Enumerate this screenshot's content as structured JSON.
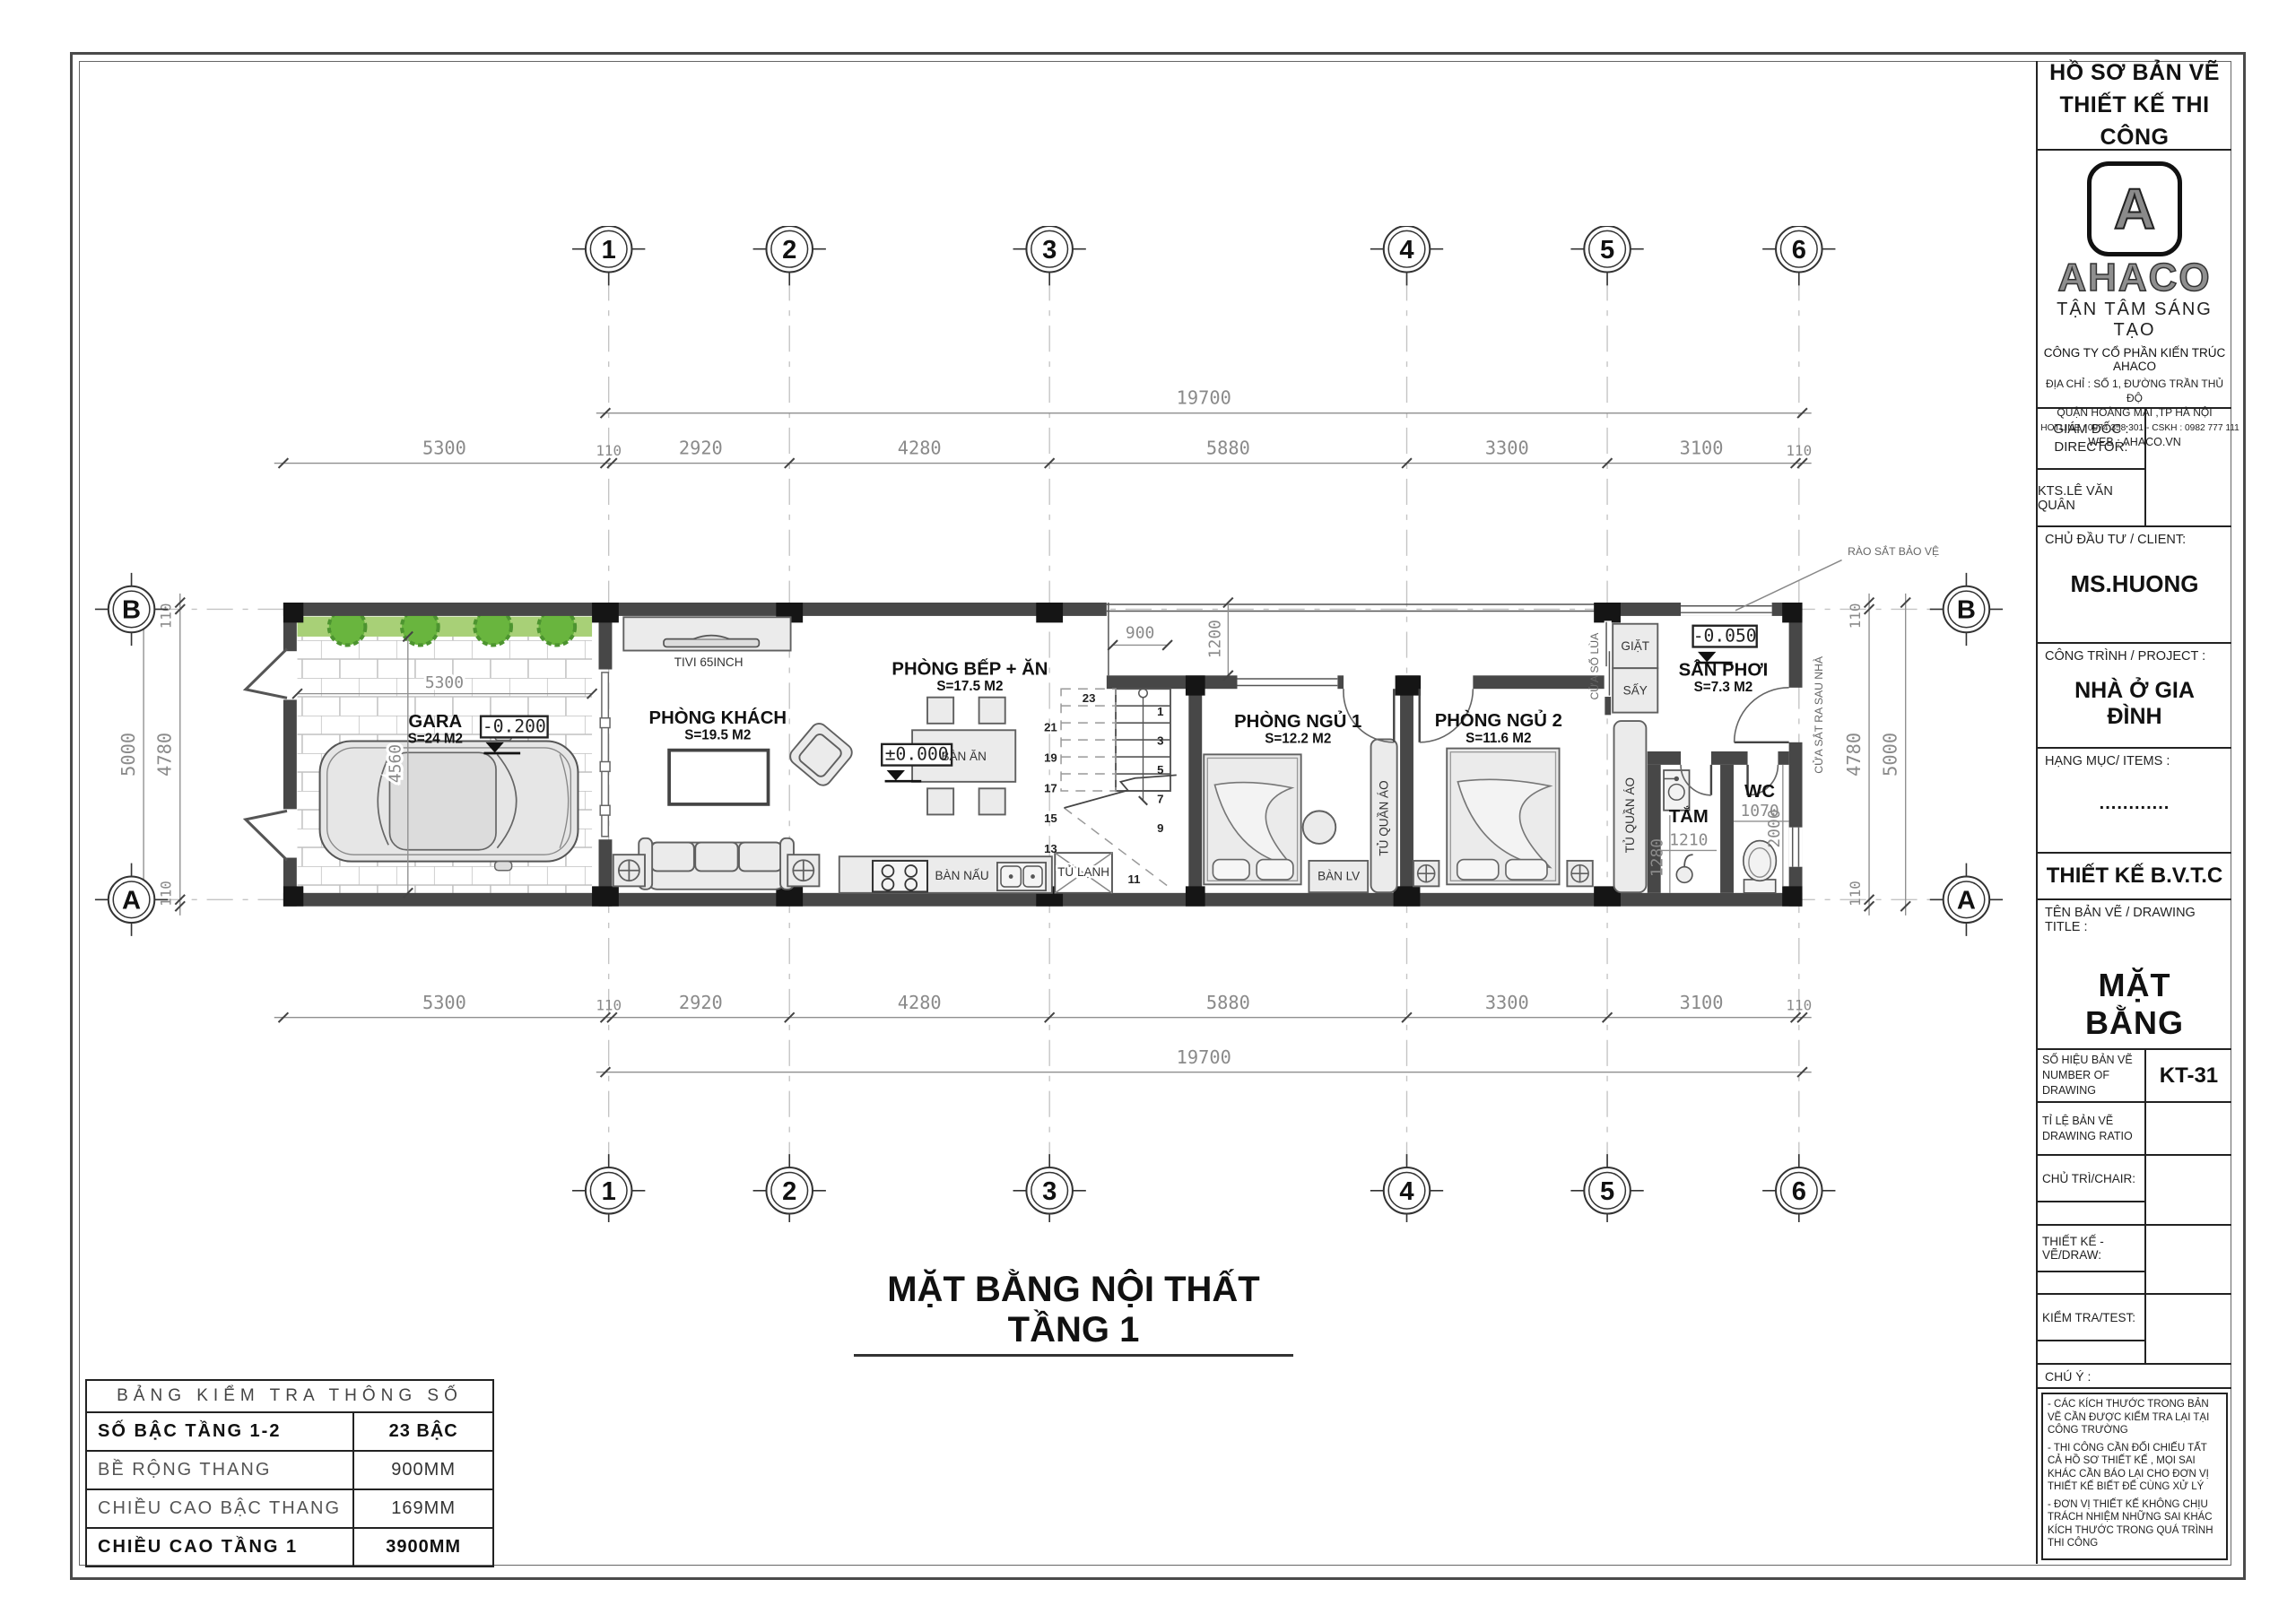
{
  "title_block": {
    "header_line1": "HỒ SƠ BẢN VẼ",
    "header_line2": "THIẾT KẾ THI CÔNG",
    "logo_letter": "A",
    "logo_text": "AHACO",
    "tagline": "TẬN TÂM SÁNG TẠO",
    "company": "CÔNG TY CỔ PHẦN KIẾN TRÚC AHACO",
    "address1": "ĐỊA CHỈ : SỐ 1, ĐƯỜNG TRẦN THỦ ĐỘ",
    "address2": "QUẬN HOÀNG MAI ,TP HÀ NỘI",
    "hotline": "HOTLINE :  0974 358 301   -  CSKH : 0982 777 111",
    "web": "WEB : AHACO.VN",
    "director_label1": "GIÁM ĐỐC :",
    "director_label2": "DIRECTOR:",
    "architect": "KTS.LÊ VĂN QUÂN",
    "client_label": "CHỦ ĐẦU TƯ / CLIENT:",
    "client": "MS.HUONG",
    "project_label": "CÔNG TRÌNH / PROJECT :",
    "project": "NHÀ Ở GIA ĐÌNH",
    "items_label": "HẠNG MỤC/ ITEMS :",
    "items": "............",
    "design_stage": "THIẾT KẾ B.V.T.C",
    "drawing_title_label": "TÊN BẢN VẼ / DRAWING TITLE :",
    "drawing_title": "MẶT BẰNG",
    "number_label1": "SỐ HIỆU BẢN VẼ",
    "number_label2": "NUMBER OF DRAWING",
    "number": "KT-31",
    "ratio_label1": "TỈ LỆ BẢN VẼ",
    "ratio_label2": "DRAWING RATIO",
    "chair_label": "CHỦ TRÌ/CHAIR:",
    "draw_label": "THIẾT KẾ - VẼ/DRAW:",
    "test_label": "KIỂM TRA/TEST:",
    "note_label": "CHÚ Ý :",
    "notes": [
      "- CÁC KÍCH THƯỚC TRONG BẢN VẼ CẦN ĐƯỢC KIỂM TRA LẠI TẠI CÔNG TRƯỜNG",
      "- THI CÔNG CẦN ĐỐI CHIẾU TẤT CẢ HỒ SƠ THIẾT KẾ , MỌI SAI KHÁC CẦN BÁO LẠI CHO ĐƠN VỊ THIẾT KẾ BIẾT ĐỂ CÙNG XỬ LÝ",
      "- ĐƠN VỊ THIẾT KẾ KHÔNG CHỊU TRÁCH NHIỆM NHỮNG SAI KHÁC KÍCH THƯỚC TRONG QUÁ TRÌNH THI CÔNG"
    ]
  },
  "param_table": {
    "title": "BẢNG KIỂM TRA THÔNG SỐ",
    "rows": [
      {
        "label": "SỐ BẬC TẦNG 1-2",
        "value": "23 BẬC"
      },
      {
        "label": "BỀ RỘNG THANG",
        "value": "900MM"
      },
      {
        "label": "CHIỀU CAO BẬC THANG",
        "value": "169MM"
      },
      {
        "label": "CHIỀU CAO TẦNG 1",
        "value": "3900MM"
      }
    ]
  },
  "main_title": "MẶT BẰNG NỘI THẤT TẦNG 1",
  "plan": {
    "grid": {
      "cols": [
        "1",
        "2",
        "3",
        "4",
        "5",
        "6"
      ],
      "rows": [
        "A",
        "B"
      ]
    },
    "dims": {
      "overall": "19700",
      "garage": "5300",
      "segments": [
        "110",
        "2920",
        "4280",
        "5880",
        "3300",
        "3100",
        "110"
      ],
      "v_overall": "5000",
      "v_segments": [
        "110",
        "4780",
        "110"
      ],
      "garage_w": "5300",
      "garage_h": "4560",
      "stair_w": "900",
      "void_d": "1200",
      "bath_w": "1280",
      "bath_l": "1210",
      "wc_w": "1070",
      "wc_d": "2000"
    },
    "rooms": [
      {
        "name": "GARA",
        "area": "S=24 M2"
      },
      {
        "name": "PHÒNG KHÁCH",
        "area": "S=19.5 M2"
      },
      {
        "name": "PHÒNG BẾP + ĂN",
        "area": "S=17.5 M2"
      },
      {
        "name": "PHÒNG NGỦ 1",
        "area": "S=12.2 M2"
      },
      {
        "name": "PHÒNG NGỦ 2",
        "area": "S=11.6 M2"
      },
      {
        "name": "SÂN PHƠI",
        "area": "S=7.3 M2"
      },
      {
        "name": "TẮM",
        "area": ""
      },
      {
        "name": "WC",
        "area": ""
      }
    ],
    "levels": {
      "gara": "-0.200",
      "living": "±0.000",
      "san": "-0.050"
    },
    "furniture": {
      "tivi": "TIVI 65INCH",
      "ban_an": "BÀN ĂN",
      "ban_nau": "BÀN NẤU",
      "tu_lanh": "TỦ LẠNH",
      "ban_lv": "BÀN LV",
      "tu_quan_ao": "TỦ QUẦN ÁO",
      "giat": "GIẶT",
      "say": "SẤY"
    },
    "annotations": {
      "rao_sat": "RÀO SẮT BẢO VỆ",
      "cua_sat": "CỬA SẮT RA SAU NHÀ",
      "cua_so_lua": "CỬA SỔ LÙA"
    },
    "stairs": {
      "numbers": [
        "1",
        "3",
        "5",
        "7",
        "9",
        "11",
        "13",
        "15",
        "17",
        "19",
        "21",
        "23"
      ]
    }
  }
}
